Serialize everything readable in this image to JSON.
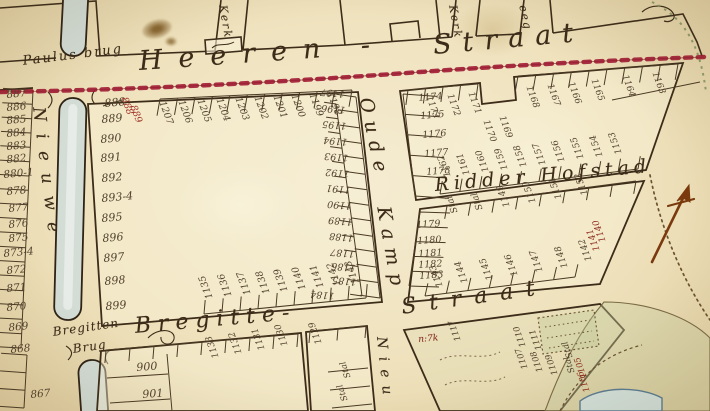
{
  "map_type": "historical-cadastral-street-map",
  "colors": {
    "paper": "#efe2bd",
    "ink": "#3c2c19",
    "number_ink": "#52422e",
    "red_dotted_boundary": "#9e1430",
    "red_annotation_ink": "#8d2b1d",
    "canal_fill": "#d3ddd6",
    "green_dotted_line": "#7f935f",
    "compass_arrow": "#7a3a0e"
  },
  "place_labels": [
    {
      "text": "Heeren -",
      "x": 138,
      "y": 48,
      "rot": -4,
      "size": 27,
      "ls": 16
    },
    {
      "text": "Straat",
      "x": 432,
      "y": 32,
      "rot": -5,
      "size": 27,
      "ls": 11
    },
    {
      "text": "Paulus brug",
      "x": 22,
      "y": 55,
      "rot": -7,
      "size": 13,
      "ls": 2
    },
    {
      "text": "Nieuwe",
      "x": 46,
      "y": 106,
      "rot": 83,
      "size": 17,
      "ls": 12
    },
    {
      "text": "Oude",
      "x": 374,
      "y": 96,
      "rot": 78,
      "size": 19,
      "ls": 8
    },
    {
      "text": "Kamp",
      "x": 392,
      "y": 205,
      "rot": 80,
      "size": 19,
      "ls": 8
    },
    {
      "text": "Ridder Hofstad",
      "x": 434,
      "y": 176,
      "rot": -5,
      "size": 19,
      "ls": 5
    },
    {
      "text": "Bregitte-",
      "x": 134,
      "y": 316,
      "rot": -5,
      "size": 22,
      "ls": 7
    },
    {
      "text": "Straat",
      "x": 400,
      "y": 297,
      "rot": -8,
      "size": 22,
      "ls": 13
    },
    {
      "text": "Bregitten",
      "x": 52,
      "y": 326,
      "rot": -8,
      "size": 12,
      "ls": 1
    },
    {
      "text": "Brug",
      "x": 72,
      "y": 343,
      "rot": -8,
      "size": 12,
      "ls": 1
    },
    {
      "text": "Kerk",
      "x": 228,
      "y": 4,
      "rot": 80,
      "size": 11,
      "ls": 2
    },
    {
      "text": "Kerk",
      "x": 458,
      "y": 4,
      "rot": 80,
      "size": 11,
      "ls": 2
    },
    {
      "text": "eeg",
      "x": 528,
      "y": 4,
      "rot": 78,
      "size": 11,
      "ls": 2
    },
    {
      "text": "Nieu",
      "x": 388,
      "y": 336,
      "rot": 84,
      "size": 14,
      "ls": 8
    },
    {
      "text": "n:7k",
      "x": 418,
      "y": 336,
      "rot": -5,
      "size": 9,
      "ls": 0,
      "color": "#8d2b1d"
    }
  ],
  "numbers": {
    "groups": [
      {
        "id": "left-strip",
        "rot": -5,
        "size": 10.5,
        "items": [
          [
            "887",
            6,
            90
          ],
          [
            "886",
            6,
            103
          ],
          [
            "885",
            6,
            116
          ],
          [
            "884",
            6,
            129
          ],
          [
            "883",
            6,
            142
          ],
          [
            "882",
            6,
            155
          ],
          [
            "880-1",
            3,
            170
          ],
          [
            "878",
            6,
            187
          ],
          [
            "877",
            8,
            204
          ],
          [
            "876",
            8,
            220
          ],
          [
            "875",
            8,
            234
          ],
          [
            "873-4",
            3,
            249
          ],
          [
            "872",
            6,
            266
          ],
          [
            "871",
            6,
            284
          ],
          [
            "870",
            6,
            303
          ],
          [
            "869",
            8,
            323
          ],
          [
            "868",
            10,
            345
          ],
          [
            "867",
            30,
            390
          ]
        ]
      },
      {
        "id": "central-left",
        "rot": -5,
        "size": 11,
        "items": [
          [
            "888",
            104,
            98
          ],
          [
            "889",
            101,
            114
          ],
          [
            "890",
            100,
            134
          ],
          [
            "891",
            100,
            153
          ],
          [
            "892",
            101,
            173
          ],
          [
            "893-4",
            101,
            193
          ],
          [
            "895",
            101,
            213
          ],
          [
            "896",
            102,
            233
          ],
          [
            "897",
            103,
            253
          ],
          [
            "898",
            104,
            276
          ],
          [
            "899",
            105,
            301
          ]
        ]
      },
      {
        "id": "red-scribble",
        "rot": 70,
        "size": 9.5,
        "color": "#a03326",
        "items": [
          [
            "888",
            128,
            96
          ],
          [
            "889",
            137,
            104
          ]
        ]
      },
      {
        "id": "central-top",
        "rot": 70,
        "size": 9.5,
        "items": [
          [
            "1207",
            166,
            100
          ],
          [
            "1206",
            185,
            99
          ],
          [
            "1205",
            204,
            98
          ],
          [
            "1204",
            223,
            97
          ],
          [
            "1203",
            242,
            96
          ],
          [
            "1202",
            261,
            95
          ],
          [
            "1201",
            280,
            94
          ],
          [
            "1200",
            298,
            93
          ],
          [
            "1199",
            316,
            92
          ],
          [
            "1198",
            334,
            91
          ]
        ]
      },
      {
        "id": "central-right",
        "rot": 185,
        "size": 9.5,
        "items": [
          [
            "1197",
            344,
            98
          ],
          [
            "1196",
            345,
            114
          ],
          [
            "1195",
            346,
            130
          ],
          [
            "1194",
            347,
            146
          ],
          [
            "1193",
            348,
            162
          ],
          [
            "1192",
            349,
            178
          ],
          [
            "1191",
            350,
            194
          ],
          [
            "1190",
            351,
            210
          ],
          [
            "1189",
            352,
            226
          ],
          [
            "1188",
            353,
            242
          ],
          [
            "1187",
            354,
            258
          ],
          [
            "1186",
            355,
            272
          ],
          [
            "1185",
            356,
            286
          ],
          [
            "1184",
            334,
            300
          ]
        ]
      },
      {
        "id": "central-bottom",
        "rot": 250,
        "size": 9.5,
        "items": [
          [
            "1135",
            206,
            300
          ],
          [
            "1136",
            225,
            298
          ],
          [
            "1137",
            244,
            296
          ],
          [
            "1138",
            263,
            295
          ],
          [
            "1139",
            281,
            293
          ],
          [
            "1140",
            299,
            291
          ],
          [
            "1141",
            317,
            289
          ],
          [
            "1142",
            334,
            287
          ],
          [
            "1143",
            352,
            285
          ]
        ]
      },
      {
        "id": "oudekamp-west-col",
        "rot": -5,
        "size": 9.5,
        "items": [
          [
            "1174",
            418,
            94
          ],
          [
            "1175",
            420,
            112
          ],
          [
            "1176",
            422,
            131
          ],
          [
            "1177",
            424,
            150
          ],
          [
            "1178",
            426,
            168
          ]
        ]
      },
      {
        "id": "heeren-south-row-east",
        "rot": 70,
        "size": 9,
        "items": [
          [
            "1173",
            432,
            95
          ],
          [
            "1172",
            453,
            93
          ],
          [
            "1171",
            474,
            91
          ],
          [
            "1170",
            489,
            119
          ],
          [
            "1169",
            505,
            115
          ],
          [
            "1168",
            532,
            85
          ],
          [
            "1167",
            553,
            83
          ],
          [
            "1166",
            574,
            81
          ],
          [
            "1165",
            597,
            78
          ],
          [
            "1164",
            628,
            74
          ],
          [
            "1163",
            658,
            71
          ]
        ]
      },
      {
        "id": "ridderhofstad-north-row",
        "rot": 250,
        "size": 9,
        "items": [
          [
            "1162",
            445,
            178
          ],
          [
            "1161",
            464,
            176
          ],
          [
            "1160",
            483,
            173
          ],
          [
            "1159",
            502,
            171
          ],
          [
            "1158",
            521,
            168
          ],
          [
            "1157",
            540,
            166
          ],
          [
            "1156",
            559,
            163
          ],
          [
            "1155",
            578,
            160
          ],
          [
            "1154",
            597,
            158
          ],
          [
            "1153",
            616,
            155
          ]
        ]
      },
      {
        "id": "lower-right-west-col",
        "rot": -4,
        "size": 9.5,
        "items": [
          [
            "1179",
            416,
            221
          ],
          [
            "1180",
            417,
            237
          ],
          [
            "1181",
            418,
            250
          ],
          [
            "1182",
            418,
            261
          ],
          [
            "1183",
            419,
            272
          ]
        ]
      },
      {
        "id": "ridderhofstad-south-row",
        "rot": 250,
        "size": 9,
        "items": [
          [
            "Stal",
            452,
            214
          ],
          [
            "Stal",
            477,
            211
          ],
          [
            "1149",
            504,
            208
          ],
          [
            "1150",
            530,
            204
          ],
          [
            "1151",
            556,
            200
          ],
          [
            "1152",
            582,
            196
          ]
        ]
      },
      {
        "id": "lower-right-south-row",
        "rot": 250,
        "size": 9,
        "items": [
          [
            "1143",
            437,
            288
          ],
          [
            "1144",
            462,
            284
          ],
          [
            "1145",
            487,
            281
          ],
          [
            "1146",
            512,
            277
          ],
          [
            "1147",
            537,
            273
          ],
          [
            "1148",
            562,
            269
          ],
          [
            "1142",
            586,
            262
          ]
        ]
      },
      {
        "id": "lower-right-red",
        "rot": 250,
        "size": 9,
        "color": "#8d2b1d",
        "items": [
          [
            "1141",
            594,
            252
          ],
          [
            "1140",
            600,
            243
          ]
        ]
      },
      {
        "id": "bottom-left-block",
        "rot": -4,
        "size": 11,
        "items": [
          [
            "900",
            136,
            362
          ],
          [
            "901",
            142,
            389
          ]
        ]
      },
      {
        "id": "bregitte-south-row",
        "rot": 250,
        "size": 9,
        "items": [
          [
            "1133",
            213,
            359
          ],
          [
            "1132",
            236,
            355
          ],
          [
            "1131",
            259,
            351
          ],
          [
            "1130",
            282,
            347
          ],
          [
            "1129",
            316,
            345
          ]
        ]
      },
      {
        "id": "bottom-center-stal",
        "rot": 250,
        "size": 8.5,
        "items": [
          [
            "Stal",
            345,
            379
          ],
          [
            "Stal",
            342,
            402
          ]
        ]
      },
      {
        "id": "bottom-right-scribbles",
        "rot": 250,
        "size": 8.5,
        "items": [
          [
            "1110",
            520,
            348
          ],
          [
            "1111",
            536,
            351
          ],
          [
            "1107",
            522,
            370
          ],
          [
            "1108",
            537,
            373
          ],
          [
            "1109",
            552,
            376
          ],
          [
            "Stal",
            567,
            359
          ],
          [
            "Stal",
            569,
            374
          ],
          [
            "1117",
            455,
            342
          ]
        ]
      },
      {
        "id": "bottom-right-red",
        "rot": 250,
        "size": 8.5,
        "color": "#8d2b1d",
        "items": [
          [
            "1105",
            581,
            379
          ],
          [
            "1106",
            584,
            393
          ]
        ]
      }
    ]
  }
}
